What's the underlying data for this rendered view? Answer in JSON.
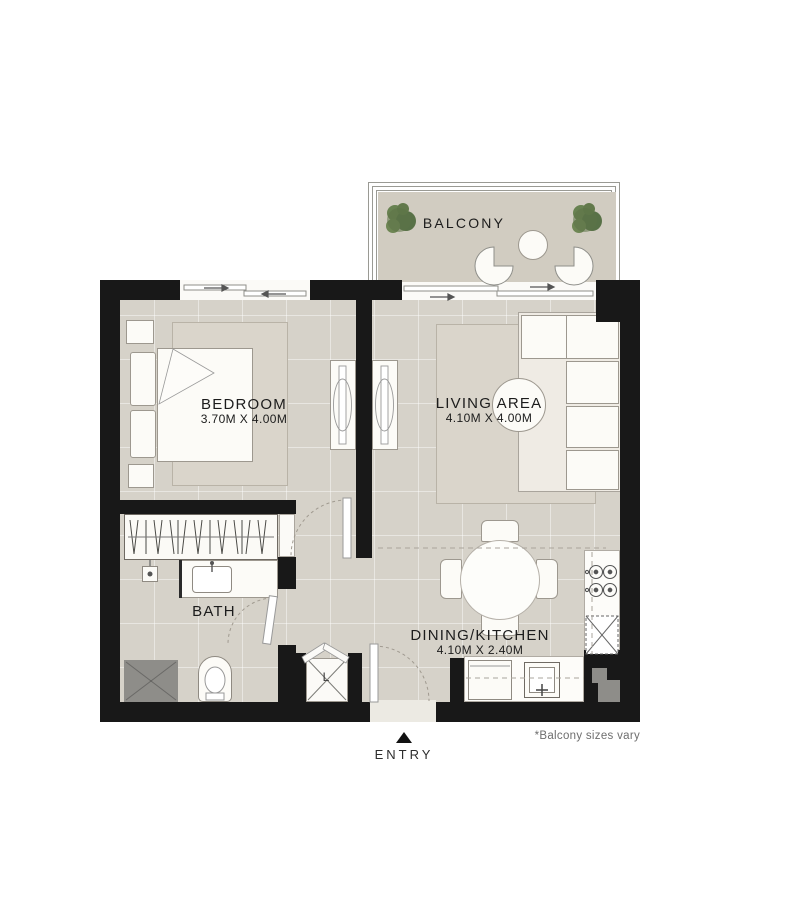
{
  "labels": {
    "balcony": "BALCONY",
    "bedroom": {
      "name": "BEDROOM",
      "dims": "3.70M X 4.00M"
    },
    "living": {
      "name": "LIVING AREA",
      "dims": "4.10M X 4.00M"
    },
    "bath": {
      "name": "BATH"
    },
    "dining": {
      "name": "DINING/KITCHEN",
      "dims": "4.10M X 2.40M"
    },
    "laundry": "L",
    "entry": "ENTRY",
    "footnote": "*Balcony sizes vary"
  },
  "colors": {
    "wall": "#181818",
    "floor": "#d6d2c9",
    "balcony_floor": "#d1ccc1",
    "rug": "#dad5cb",
    "shaft": "#8e8d89",
    "furn": "#fcfbf7",
    "line": "#98938b",
    "ink": "#1c1c1c",
    "muted": "#6e6e6e"
  }
}
